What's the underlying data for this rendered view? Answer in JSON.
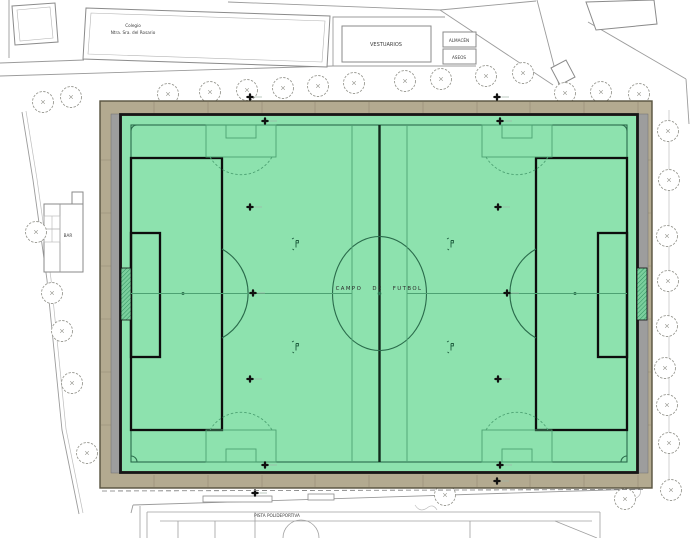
{
  "site_plan": {
    "labels": {
      "colegio_line1": "Colegio",
      "colegio_line2": "Ntra. Sra. del Rosario",
      "vestuarios": "VESTUARIOS",
      "almacen": "ALMACÉN",
      "aseos": "ASEOS",
      "bar": "BAR",
      "campo_de_futbol": "CAMPO DE FUTBOL",
      "pista_polideportiva": "PISTA POLIDEPORTIVA"
    },
    "colors": {
      "turf_green": "#8de2ae",
      "main_pitch_line": "#2a6b4b",
      "cross_pitch_line": "#4da273",
      "thick_marking": "#0d0d0d",
      "paving_tan": "#b3aa90",
      "walkway_gray": "#9d9d9d",
      "outline_gray": "#8a8a8a"
    },
    "icons": {
      "tree": "circle-scalloped",
      "sprinkler": "bold-cross",
      "penalty_marker": "small-flag"
    }
  }
}
